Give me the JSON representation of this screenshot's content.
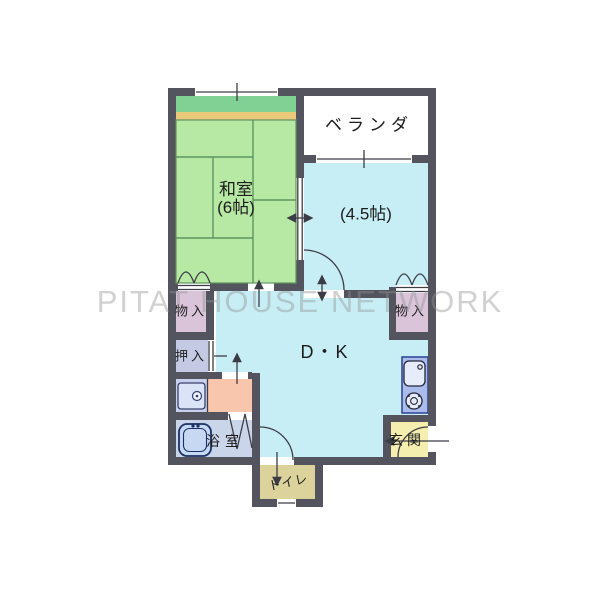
{
  "watermark": "PITAT HOUSE NETWORK",
  "rooms": {
    "veranda": {
      "label": "ベランダ"
    },
    "washitsu": {
      "name": "和室",
      "size": "(6帖)"
    },
    "western": {
      "label": "(4.5帖)"
    },
    "storage_left": {
      "label": "物入"
    },
    "storage_right": {
      "label": "物入"
    },
    "oshiire": {
      "label": "押入"
    },
    "dining_kitchen": {
      "label": "D・K"
    },
    "bathroom": {
      "label": "浴室"
    },
    "toilet": {
      "label": "トイレ"
    },
    "entrance": {
      "label": "玄関"
    }
  },
  "colors": {
    "wall": "#54545e",
    "line": "#3c3c46",
    "tatami": "#b7e9a4",
    "tatami_strip": "#82d194",
    "wood_strip": "#e9ca7b",
    "room_cyan": "#c7eef5",
    "closet_purple": "#d9c4da",
    "oshiire_blue": "#c5cae4",
    "nook_blue": "#c7d1ee",
    "washroom_pink": "#f8c5ad",
    "bath_blue": "#cbd5e9",
    "toilet_tan": "#dcd29c",
    "entrance_yellow": "#f4efae",
    "counter_blue": "#a9bcec",
    "veranda_white": "#ffffff",
    "tatami_line": "#5f945f"
  },
  "icons": {
    "bathtub": "bathtub-icon",
    "washbasin": "washbasin-icon",
    "kitchen_sink": "kitchen-sink-icon",
    "stove": "stove-icon"
  }
}
